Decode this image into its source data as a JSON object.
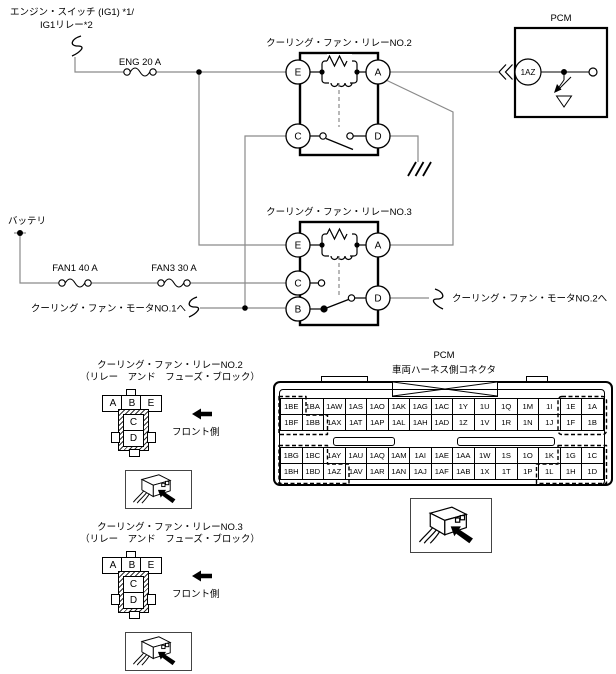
{
  "diagram": {
    "engine_switch_label_1": "エンジン・スイッチ (IG1) *1/",
    "engine_switch_label_2": "IG1リレー*2",
    "fuse_eng": "ENG 20 A",
    "battery_label": "バッテリ",
    "fuse_fan1": "FAN1 40 A",
    "fuse_fan3": "FAN3 30 A",
    "to_motor1": "クーリング・ファン・モータNO.1へ",
    "to_motor2": "クーリング・ファン・モータNO.2へ",
    "relay2": {
      "title": "クーリング・ファン・リレーNO.2",
      "t_e": "E",
      "t_a": "A",
      "t_c": "C",
      "t_d": "D"
    },
    "relay3": {
      "title": "クーリング・ファン・リレーNO.3",
      "t_e": "E",
      "t_a": "A",
      "t_c": "C",
      "t_b": "B",
      "t_d": "D"
    },
    "pcm": {
      "title": "PCM",
      "terminal": "1AZ"
    },
    "wire_color": "#8a8a8a",
    "line_color": "#000000"
  },
  "relay2_connector": {
    "title": "クーリング・ファン・リレーNO.2",
    "subtitle": "（リレー　アンド　フューズ・ブロック）",
    "pins_top": [
      "A",
      "B",
      "E"
    ],
    "pins_body": [
      "C",
      "D"
    ],
    "front_label": "フロント側"
  },
  "relay3_connector": {
    "title": "クーリング・ファン・リレーNO.3",
    "subtitle": "（リレー　アンド　フューズ・ブロック）",
    "pins_top": [
      "A",
      "B",
      "E"
    ],
    "pins_body": [
      "C",
      "D"
    ],
    "front_label": "フロント側"
  },
  "pcm_connector": {
    "title": "PCM",
    "subtitle": "車両ハーネス側コネクタ",
    "rows": [
      [
        "1BE",
        "1BA",
        "1AW",
        "1AS",
        "1AO",
        "1AK",
        "1AG",
        "1AC",
        "1Y",
        "1U",
        "1Q",
        "1M",
        "1I",
        "1E",
        "1A"
      ],
      [
        "1BF",
        "1BB",
        "1AX",
        "1AT",
        "1AP",
        "1AL",
        "1AH",
        "1AD",
        "1Z",
        "1V",
        "1R",
        "1N",
        "1J",
        "1F",
        "1B"
      ],
      [
        "1BG",
        "1BC",
        "1AY",
        "1AU",
        "1AQ",
        "1AM",
        "1AI",
        "1AE",
        "1AA",
        "1W",
        "1S",
        "1O",
        "1K",
        "1G",
        "1C"
      ],
      [
        "1BH",
        "1BD",
        "1AZ",
        "1AV",
        "1AR",
        "1AN",
        "1AJ",
        "1AF",
        "1AB",
        "1X",
        "1T",
        "1P",
        "1L",
        "1H",
        "1D"
      ]
    ]
  }
}
